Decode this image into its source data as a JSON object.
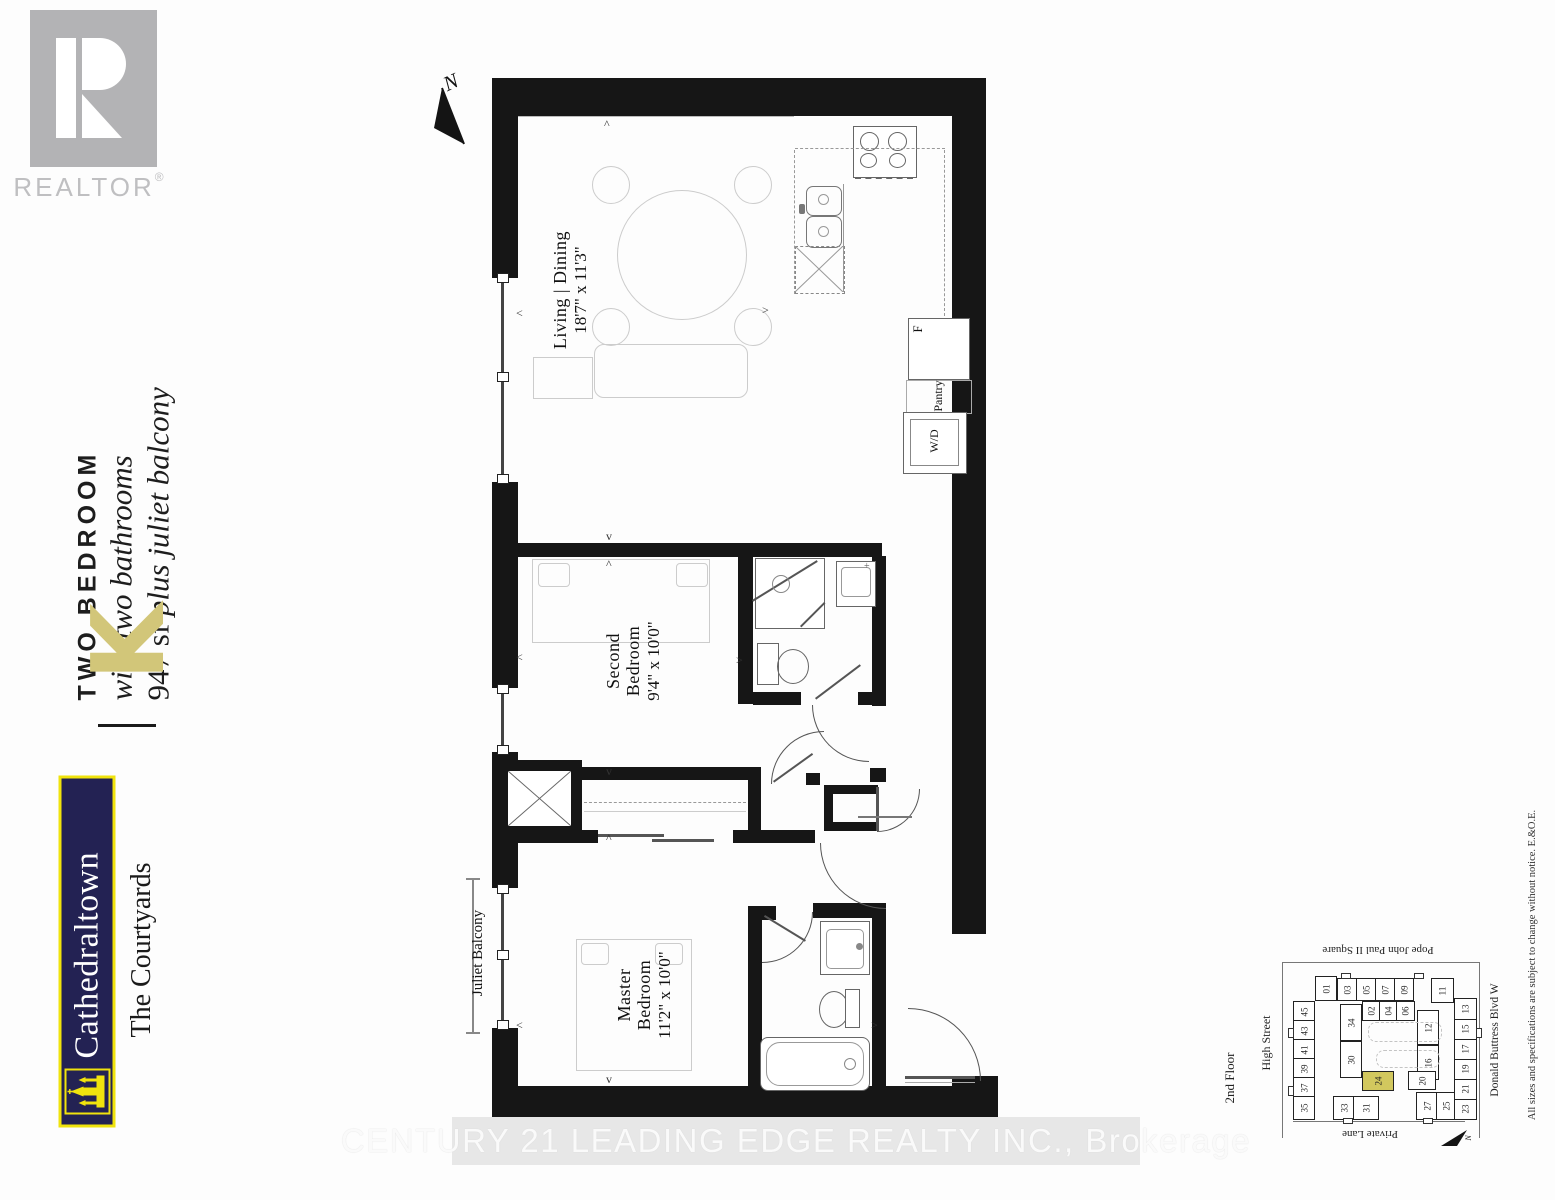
{
  "branding": {
    "realtor_logo_text": "REALTOR",
    "realtor_reg": "®",
    "unit_type": "TWO BEDROOM",
    "bath_line": "with two bathrooms",
    "size_line_prefix": "947 sf ",
    "size_line_italic": "plus juliet balcony",
    "unit_letter": "K",
    "development": "Cathedraltown",
    "community": "The Courtyards",
    "colors": {
      "gold": "#d2c679",
      "navy": "#232253",
      "yellow": "#f0e30d",
      "realtor_gray": "#b3b3b5",
      "highlight_unit": "#d2c85e"
    }
  },
  "floor_plan": {
    "north_label": "N",
    "rooms": [
      {
        "id": "living",
        "line1": "Living | Dining",
        "line2": "",
        "dims": "18'7\" x 11'3\""
      },
      {
        "id": "second",
        "line1": "Second",
        "line2": "Bedroom",
        "dims": "9'4\" x 10'0\""
      },
      {
        "id": "master",
        "line1": "Master",
        "line2": "Bedroom",
        "dims": "11'2\" x 10'0\""
      }
    ],
    "labels": {
      "juliet_balcony": "Juliet Balcony",
      "pantry": "Pantry",
      "washer_dryer": "W/D",
      "fridge": "F"
    },
    "markers": [
      {
        "c": "^",
        "x": 604,
        "y": 117
      },
      {
        "c": "<",
        "x": 516,
        "y": 306
      },
      {
        "c": ">",
        "x": 762,
        "y": 303
      },
      {
        "c": "v",
        "x": 606,
        "y": 529
      },
      {
        "c": "^",
        "x": 606,
        "y": 557
      },
      {
        "c": "<",
        "x": 516,
        "y": 650
      },
      {
        "c": ">",
        "x": 736,
        "y": 653
      },
      {
        "c": "v",
        "x": 606,
        "y": 764
      },
      {
        "c": "^",
        "x": 606,
        "y": 831
      },
      {
        "c": "<",
        "x": 516,
        "y": 1018
      },
      {
        "c": ">",
        "x": 871,
        "y": 1018
      },
      {
        "c": "v",
        "x": 606,
        "y": 1072
      }
    ]
  },
  "site_plan": {
    "floor_label": "2nd Floor",
    "north_label": "N",
    "streets": {
      "left": "High Street",
      "top": "Pope John Paul II Square",
      "right": "Donald Buttress Blvd W",
      "bottom": "Private Lane"
    },
    "highlighted_unit": "24",
    "units": [
      {
        "n": "01",
        "x": 27,
        "y": 8,
        "w": 20,
        "h": 23
      },
      {
        "n": "03",
        "x": 49,
        "y": 10,
        "w": 18,
        "h": 21
      },
      {
        "n": "05",
        "x": 68,
        "y": 10,
        "w": 18,
        "h": 21
      },
      {
        "n": "07",
        "x": 87,
        "y": 10,
        "w": 18,
        "h": 21
      },
      {
        "n": "09",
        "x": 106,
        "y": 10,
        "w": 18,
        "h": 21
      },
      {
        "n": "11",
        "x": 143,
        "y": 10,
        "w": 21,
        "h": 23
      },
      {
        "n": "45",
        "x": 5,
        "y": 33,
        "w": 20,
        "h": 19
      },
      {
        "n": "43",
        "x": 5,
        "y": 52,
        "w": 20,
        "h": 19
      },
      {
        "n": "41",
        "x": 5,
        "y": 71,
        "w": 20,
        "h": 19
      },
      {
        "n": "39",
        "x": 5,
        "y": 90,
        "w": 20,
        "h": 19
      },
      {
        "n": "37",
        "x": 5,
        "y": 109,
        "w": 20,
        "h": 19
      },
      {
        "n": "35",
        "x": 5,
        "y": 128,
        "w": 20,
        "h": 22
      },
      {
        "n": "33",
        "x": 45,
        "y": 128,
        "w": 20,
        "h": 22
      },
      {
        "n": "31",
        "x": 65,
        "y": 128,
        "w": 24,
        "h": 22
      },
      {
        "n": "27",
        "x": 128,
        "y": 124,
        "w": 20,
        "h": 26
      },
      {
        "n": "25",
        "x": 148,
        "y": 124,
        "w": 18,
        "h": 26
      },
      {
        "n": "23",
        "x": 166,
        "y": 130,
        "w": 21,
        "h": 20
      },
      {
        "n": "21",
        "x": 166,
        "y": 110,
        "w": 21,
        "h": 20
      },
      {
        "n": "19",
        "x": 166,
        "y": 90,
        "w": 21,
        "h": 20
      },
      {
        "n": "17",
        "x": 166,
        "y": 70,
        "w": 21,
        "h": 20
      },
      {
        "n": "15",
        "x": 166,
        "y": 50,
        "w": 21,
        "h": 20
      },
      {
        "n": "13",
        "x": 166,
        "y": 30,
        "w": 21,
        "h": 20
      },
      {
        "n": "02",
        "x": 74,
        "y": 33,
        "w": 17,
        "h": 18
      },
      {
        "n": "04",
        "x": 91,
        "y": 33,
        "w": 17,
        "h": 18
      },
      {
        "n": "06",
        "x": 108,
        "y": 33,
        "w": 17,
        "h": 18
      },
      {
        "n": "34",
        "x": 52,
        "y": 36,
        "w": 20,
        "h": 35
      },
      {
        "n": "30",
        "x": 52,
        "y": 73,
        "w": 20,
        "h": 35
      },
      {
        "n": "12",
        "x": 129,
        "y": 42,
        "w": 20,
        "h": 33
      },
      {
        "n": "16",
        "x": 129,
        "y": 77,
        "w": 20,
        "h": 33
      },
      {
        "n": "20",
        "x": 120,
        "y": 103,
        "w": 26,
        "h": 17
      },
      {
        "n": "24",
        "x": 74,
        "y": 103,
        "w": 30,
        "h": 18,
        "hl": true
      }
    ]
  },
  "disclaimer": "All sizes and specifications are subject to change without notice. E.&O.E.",
  "watermark": "CENTURY 21 LEADING EDGE REALTY INC., Brokerage"
}
